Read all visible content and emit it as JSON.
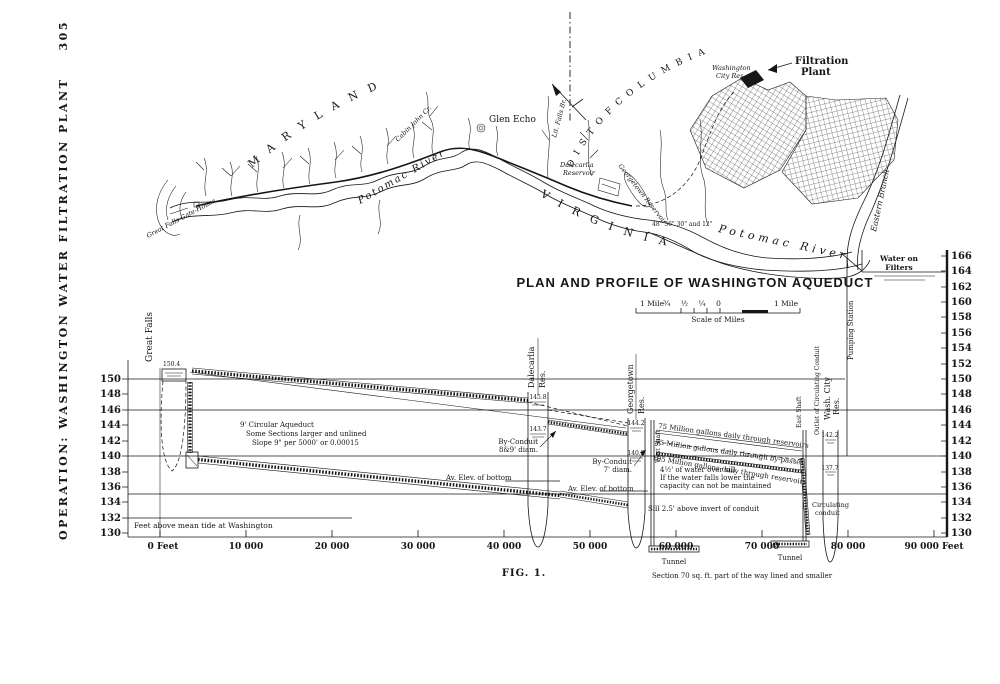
{
  "page": {
    "side_caption": "OPERATION: WASHINGTON WATER FILTRATION PLANT",
    "page_number": "305",
    "fig_caption": "FIG. 1.",
    "ink": "#161616",
    "paper": "#ffffff"
  },
  "map": {
    "region_maryland": "M A R Y L A N D",
    "region_district": "D I S T  O F  C O L U M B I A",
    "region_virginia": "V I R G I N I A",
    "glen_echo": "Glen Echo",
    "lit_falls": "Lit. Falls Br.",
    "cabin_john": "Cabin John Cr.",
    "potomac_upper": "Potomac River",
    "potomac_lower": "Potomac River",
    "gatehouse": "Great Falls Gate-House",
    "dalecarlia_1": "Dalecarlia",
    "dalecarlia_2": "Reservoir",
    "georgetown_res": "Georgetown Reservoir",
    "wash_city_1": "Washington",
    "wash_city_2": "City Res.",
    "filtration_1": "Filtration",
    "filtration_2": "Plant",
    "eastern_branch": "Eastern Branch",
    "conduit_sizes": "48\" 36\" 30\" and 12\""
  },
  "profile": {
    "title": "PLAN AND PROFILE OF WASHINGTON AQUEDUCT",
    "scale": {
      "left": "1 Mile",
      "fractions": "¾ ½ ¼ 0",
      "right": "1 Mile",
      "caption": "Scale of Miles"
    },
    "axis_left": [
      "150",
      "148",
      "146",
      "144",
      "142",
      "140",
      "138",
      "136",
      "134",
      "132",
      "130"
    ],
    "axis_right": [
      "166",
      "164",
      "162",
      "160",
      "158",
      "156",
      "154",
      "152",
      "150",
      "148",
      "146",
      "144",
      "142",
      "140",
      "138",
      "136",
      "134",
      "132",
      "130"
    ],
    "axis_bottom": [
      "0 Feet",
      "10 000",
      "20 000",
      "30 000",
      "40 000",
      "50 000",
      "60 000",
      "70 000",
      "80 000",
      "90 000 Feet"
    ],
    "datum_note": "Feet above mean tide at Washington",
    "stations": {
      "great_falls": "Great Falls",
      "dalecarlia_a": "Dalecarlia",
      "dalecarlia_b": "Res.",
      "georgetown_a": "Georgetown",
      "georgetown_b": "Res.",
      "west_shaft": "West Shaft",
      "east_shaft": "East Shaft",
      "outlet": "Outlet of Circulating Conduit",
      "wash_a": "Wash. City",
      "wash_b": "Res.",
      "pumping": "Pumping Station",
      "filters_a": "Water on",
      "filters_b": "Filters"
    },
    "elev": {
      "gf": "150.4",
      "dal_hi": "145.8",
      "dal_lo": "143.7",
      "geo_hi": "144.2",
      "geo_lo": "140.2",
      "city_hi": "142.2",
      "city_lo": "137.7"
    },
    "ann": {
      "aq1": "9' Circular Aqueduct",
      "aq2": "Some Sections larger and unlined",
      "aq3": "Slope 9\" per 5000' or 0.00015",
      "byc1a": "By-Conduit",
      "byc1b": "8&9' diam.",
      "byc2a": "By-Conduit",
      "byc2b": "7' diam.",
      "avelev1": "Av. Elev. of bottom",
      "avelev2": "Av. Elev. of bottom",
      "flow1": "75 Million gallons daily through reservoirs",
      "flow2": "75 Million gallons daily through by-passes",
      "flow3": "105 Million gallons daily through reservoirs",
      "sill1": "4½' of water over sill",
      "sill2": "If the water falls lower the",
      "sill3": "capacity can not be maintained",
      "sill4": "Sill 2.5' above invert of conduit",
      "circ1": "Circulating",
      "circ2": "conduit",
      "tunnel1": "Tunnel",
      "tunnel2": "Tunnel",
      "section": "Section 70 sq. ft. part of the way lined and smaller"
    }
  },
  "chart_data": {
    "type": "line",
    "title": "PLAN AND PROFILE OF WASHINGTON AQUEDUCT",
    "xlabel": "Distance along aqueduct (feet)",
    "ylabel": "Feet above mean tide at Washington",
    "xlim": [
      0,
      90000
    ],
    "ylim": [
      130,
      166
    ],
    "x_ticks": [
      0,
      10000,
      20000,
      30000,
      40000,
      50000,
      60000,
      70000,
      80000,
      90000
    ],
    "y_ticks": [
      130,
      132,
      134,
      136,
      138,
      140,
      142,
      144,
      146,
      148,
      150,
      152,
      154,
      156,
      158,
      160,
      162,
      164,
      166
    ],
    "grid": "horizontal reference lines at 150, 146, 140 and 135 ft",
    "legend_position": "none",
    "series": [
      {
        "name": "Water surface in 9' circular aqueduct (slope 0.00015)",
        "x": [
          0,
          43000
        ],
        "y": [
          151,
          145.8
        ]
      },
      {
        "name": "Average elevation of conduit bottom",
        "x": [
          4500,
          50000,
          58000
        ],
        "y": [
          141.5,
          135.5,
          133.5
        ]
      },
      {
        "name": "By-conduit grade Dalecarlia to Georgetown",
        "x": [
          48500,
          57500
        ],
        "y": [
          144.6,
          143.2
        ]
      },
      {
        "name": "Grade Georgetown to East Shaft (75-105 MGD)",
        "x": [
          60500,
          75000
        ],
        "y": [
          143.5,
          141
        ]
      },
      {
        "name": "Water on filters",
        "x": [
          82000,
          90000
        ],
        "y": [
          164,
          164
        ]
      }
    ],
    "stations": [
      {
        "name": "Great Falls",
        "x": 0,
        "water_elev": 150.4
      },
      {
        "name": "Dalecarlia Res.",
        "x": 43000,
        "high_water": 145.8,
        "low_water": 143.7
      },
      {
        "name": "Georgetown Res.",
        "x": 55000,
        "high_water": 144.2,
        "low_water": 140.2
      },
      {
        "name": "Wash. City Res.",
        "x": 77000,
        "high_water": 142.2,
        "low_water": 137.7
      },
      {
        "name": "Water on Filters",
        "x": 88000,
        "elev": 164
      }
    ]
  }
}
